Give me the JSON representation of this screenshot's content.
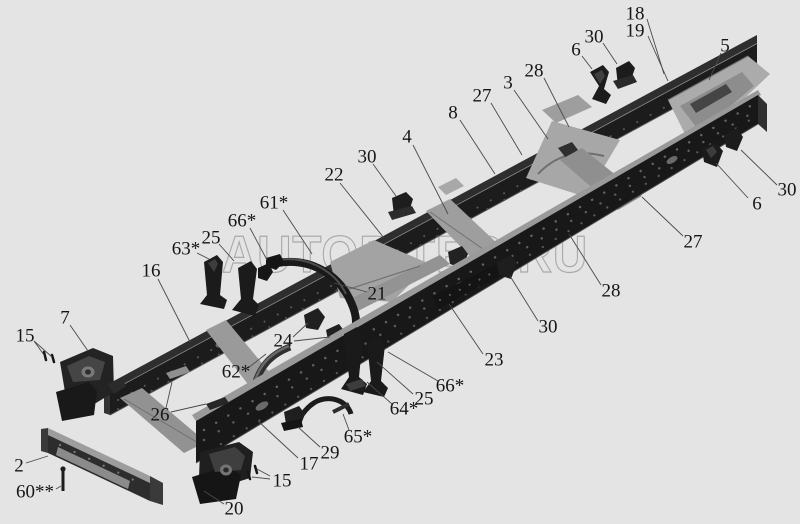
{
  "page": {
    "kind": "truck-chassis-frame-parts-diagram",
    "background_color": "#e4e4e4"
  },
  "watermark": {
    "text": "AUTOPITER.RU",
    "color": "#a9a9a9"
  },
  "palette": {
    "rail_dark": "#1c1c1c",
    "rail_flange_light": "#9a9a9a",
    "crossmember_light": "#a7a7a7",
    "bracket_dark": "#1f1f1f",
    "label_text": "#161616",
    "leader_line": "#4a4a4a"
  },
  "callouts": [
    {
      "id": "18",
      "label": "18",
      "x": 635,
      "y": 14,
      "leaders": [
        [
          647,
          19,
          664,
          74
        ]
      ]
    },
    {
      "id": "19",
      "label": "19",
      "x": 635,
      "y": 31,
      "leaders": [
        [
          648,
          36,
          668,
          81
        ]
      ]
    },
    {
      "id": "30-top",
      "label": "30",
      "x": 594,
      "y": 37,
      "leaders": [
        [
          603,
          43,
          617,
          64
        ]
      ]
    },
    {
      "id": "6-top",
      "label": "6",
      "x": 576,
      "y": 50,
      "leaders": [
        [
          582,
          56,
          592,
          69
        ]
      ]
    },
    {
      "id": "5",
      "label": "5",
      "x": 725,
      "y": 46,
      "leaders": [
        [
          721,
          53,
          709,
          80
        ]
      ]
    },
    {
      "id": "28-top",
      "label": "28",
      "x": 534,
      "y": 71,
      "leaders": [
        [
          544,
          78,
          569,
          127
        ]
      ]
    },
    {
      "id": "3",
      "label": "3",
      "x": 508,
      "y": 83,
      "leaders": [
        [
          514,
          90,
          548,
          139
        ]
      ]
    },
    {
      "id": "27-top",
      "label": "27",
      "x": 482,
      "y": 96,
      "leaders": [
        [
          491,
          103,
          522,
          155
        ]
      ]
    },
    {
      "id": "8",
      "label": "8",
      "x": 453,
      "y": 113,
      "leaders": [
        [
          460,
          120,
          495,
          174
        ]
      ]
    },
    {
      "id": "4",
      "label": "4",
      "x": 407,
      "y": 137,
      "leaders": [
        [
          413,
          145,
          448,
          214
        ]
      ]
    },
    {
      "id": "30-left",
      "label": "30",
      "x": 367,
      "y": 157,
      "leaders": [
        [
          373,
          164,
          396,
          196
        ]
      ]
    },
    {
      "id": "22",
      "label": "22",
      "x": 334,
      "y": 175,
      "leaders": [
        [
          340,
          183,
          384,
          238
        ]
      ]
    },
    {
      "id": "61",
      "label": "61*",
      "x": 274,
      "y": 203,
      "leaders": [
        [
          283,
          210,
          312,
          254
        ]
      ]
    },
    {
      "id": "66-left",
      "label": "66*",
      "x": 242,
      "y": 221,
      "leaders": [
        [
          250,
          228,
          267,
          260
        ]
      ]
    },
    {
      "id": "25-left",
      "label": "25",
      "x": 211,
      "y": 238,
      "leaders": [
        [
          219,
          244,
          234,
          261
        ]
      ]
    },
    {
      "id": "63",
      "label": "63*",
      "x": 186,
      "y": 249,
      "leaders": [
        [
          197,
          253,
          209,
          259
        ]
      ]
    },
    {
      "id": "30-right",
      "label": "30",
      "x": 787,
      "y": 190,
      "leaders": [
        [
          777,
          185,
          741,
          150
        ]
      ]
    },
    {
      "id": "6-right",
      "label": "6",
      "x": 757,
      "y": 204,
      "leaders": [
        [
          748,
          198,
          716,
          163
        ]
      ]
    },
    {
      "id": "27-right",
      "label": "27",
      "x": 693,
      "y": 242,
      "leaders": [
        [
          683,
          236,
          642,
          197
        ]
      ]
    },
    {
      "id": "28-bottom",
      "label": "28",
      "x": 611,
      "y": 291,
      "leaders": [
        [
          601,
          285,
          569,
          234
        ]
      ]
    },
    {
      "id": "30-mid",
      "label": "30",
      "x": 548,
      "y": 327,
      "leaders": [
        [
          538,
          321,
          510,
          276
        ]
      ]
    },
    {
      "id": "23",
      "label": "23",
      "x": 494,
      "y": 360,
      "leaders": [
        [
          483,
          354,
          449,
          304
        ]
      ]
    },
    {
      "id": "66-right",
      "label": "66*",
      "x": 450,
      "y": 386,
      "leaders": [
        [
          438,
          381,
          388,
          352
        ]
      ]
    },
    {
      "id": "25-right",
      "label": "25",
      "x": 424,
      "y": 399,
      "leaders": [
        [
          413,
          394,
          377,
          362
        ]
      ]
    },
    {
      "id": "64",
      "label": "64*",
      "x": 404,
      "y": 409,
      "leaders": [
        [
          392,
          404,
          367,
          382
        ]
      ]
    },
    {
      "id": "65",
      "label": "65*",
      "x": 358,
      "y": 437,
      "leaders": [
        [
          349,
          430,
          343,
          414
        ]
      ]
    },
    {
      "id": "29",
      "label": "29",
      "x": 330,
      "y": 453,
      "leaders": [
        [
          320,
          447,
          298,
          427
        ]
      ]
    },
    {
      "id": "17",
      "label": "17",
      "x": 309,
      "y": 464,
      "leaders": [
        [
          298,
          458,
          258,
          421
        ]
      ]
    },
    {
      "id": "15-bottom",
      "label": "15",
      "x": 282,
      "y": 481,
      "leaders": [
        [
          270,
          479,
          252,
          477
        ],
        [
          270,
          476,
          257,
          469
        ]
      ]
    },
    {
      "id": "20",
      "label": "20",
      "x": 234,
      "y": 509,
      "leaders": [
        [
          224,
          504,
          204,
          491
        ]
      ]
    },
    {
      "id": "16",
      "label": "16",
      "x": 151,
      "y": 271,
      "leaders": [
        [
          158,
          279,
          190,
          342
        ]
      ]
    },
    {
      "id": "7",
      "label": "7",
      "x": 65,
      "y": 318,
      "leaders": [
        [
          70,
          325,
          88,
          351
        ]
      ]
    },
    {
      "id": "15-left",
      "label": "15",
      "x": 25,
      "y": 336,
      "leaders": [
        [
          34,
          341,
          44,
          355
        ],
        [
          34,
          341,
          52,
          357
        ]
      ]
    },
    {
      "id": "21",
      "label": "21",
      "x": 377,
      "y": 294,
      "leaders": [
        [
          367,
          292,
          334,
          283
        ]
      ]
    },
    {
      "id": "24",
      "label": "24",
      "x": 283,
      "y": 341,
      "leaders": [
        [
          293,
          337,
          308,
          323
        ],
        [
          294,
          341,
          330,
          337
        ]
      ]
    },
    {
      "id": "62",
      "label": "62*",
      "x": 236,
      "y": 372,
      "leaders": [
        [
          248,
          368,
          266,
          354
        ]
      ]
    },
    {
      "id": "26",
      "label": "26",
      "x": 160,
      "y": 415,
      "leaders": [
        [
          166,
          408,
          172,
          382
        ],
        [
          171,
          412,
          206,
          404
        ]
      ]
    },
    {
      "id": "2",
      "label": "2",
      "x": 19,
      "y": 466,
      "leaders": [
        [
          26,
          463,
          48,
          456
        ]
      ]
    },
    {
      "id": "60",
      "label": "60**",
      "x": 35,
      "y": 492,
      "leaders": [
        [
          56,
          489,
          61,
          486
        ]
      ]
    }
  ]
}
